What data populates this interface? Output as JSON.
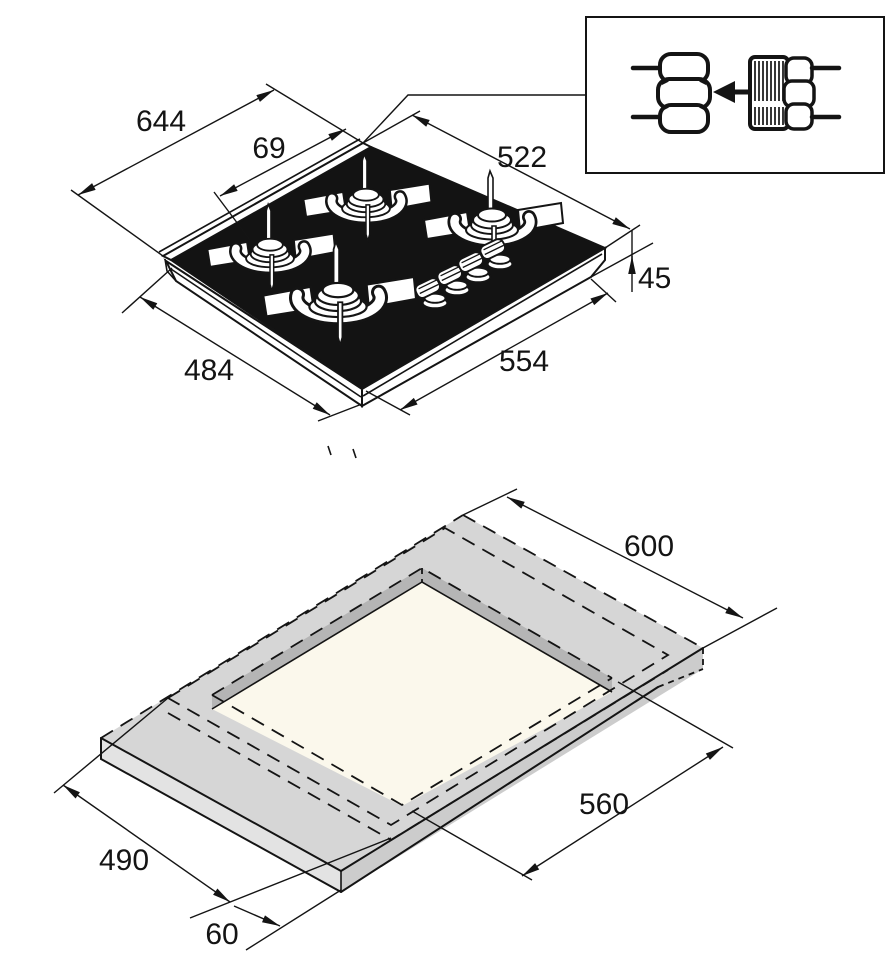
{
  "diagram": {
    "kind": "appliance-installation-drawing",
    "views": [
      "hob-isometric-top-view",
      "worktop-cutout-view"
    ]
  },
  "top_view": {
    "name": "gas-hob-isometric-view",
    "burner_count": 4,
    "knob_count": 4,
    "dims": {
      "overall_width": "644",
      "burner_edge_offset": "69",
      "overall_depth": "522",
      "build_in_height": "45",
      "body_width": "484",
      "body_depth": "554"
    }
  },
  "inset": {
    "name": "gas-connection-detail",
    "icons": [
      "union-nut-icon",
      "insert-direction-arrow-icon",
      "threaded-fitting-icon"
    ]
  },
  "bottom_view": {
    "name": "worktop-cutout-view",
    "dims": {
      "worktop_depth": "600",
      "cutout_width": "560",
      "cutout_depth": "490",
      "front_clearance": "60"
    }
  },
  "colors": {
    "glass_black": "#131313",
    "line_black": "#141414",
    "worktop_top": "#d6d6d6",
    "worktop_side_left": "#e3e3e3",
    "worktop_side_right": "#cccccc",
    "cutout_wall": "#b5b5b5",
    "cutout_floor": "#fbf8ec"
  }
}
